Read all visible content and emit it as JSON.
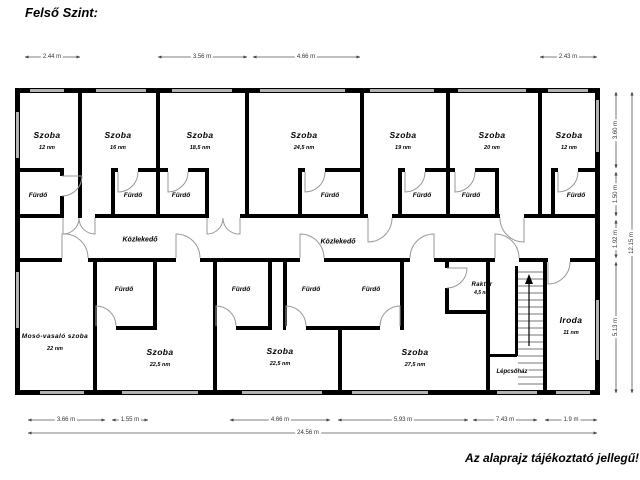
{
  "title": "Felső Szint:",
  "footnote": "Az alaprajz tájékoztató jellegű!",
  "labels": {
    "bathroom": "Fürdő",
    "corridor": "Közlekedő",
    "staircase": "Lépcsőház"
  },
  "rooms": [
    {
      "name": "Szoba",
      "area": "12 nm"
    },
    {
      "name": "Szoba",
      "area": "16 nm"
    },
    {
      "name": "Szoba",
      "area": "18,5 nm"
    },
    {
      "name": "Szoba",
      "area": "24,5 nm"
    },
    {
      "name": "Szoba",
      "area": "19 nm"
    },
    {
      "name": "Szoba",
      "area": "20 nm"
    },
    {
      "name": "Szoba",
      "area": "12 nm"
    },
    {
      "name": "Mosó-vasaló szoba",
      "area": "22 nm"
    },
    {
      "name": "Szoba",
      "area": "22,5 nm"
    },
    {
      "name": "Szoba",
      "area": "22,5 nm"
    },
    {
      "name": "Szoba",
      "area": "27,5 nm"
    },
    {
      "name": "Raktár",
      "area": "4,5 nm"
    },
    {
      "name": "Iroda",
      "area": "11 nm"
    }
  ],
  "dimensions": {
    "top": [
      "2.44 m",
      "3.56 m",
      "4.66 m",
      "2.43 m"
    ],
    "bottom": [
      "3.66 m",
      "1.55 m",
      "4.66 m",
      "5.93 m",
      "7.43 m",
      "1.9 m"
    ],
    "bottom_total": "24.56 m",
    "right": [
      "3.60 m",
      "1.50 m",
      "1.92 m",
      "5.13 m"
    ],
    "right_total": "12.15 m"
  }
}
